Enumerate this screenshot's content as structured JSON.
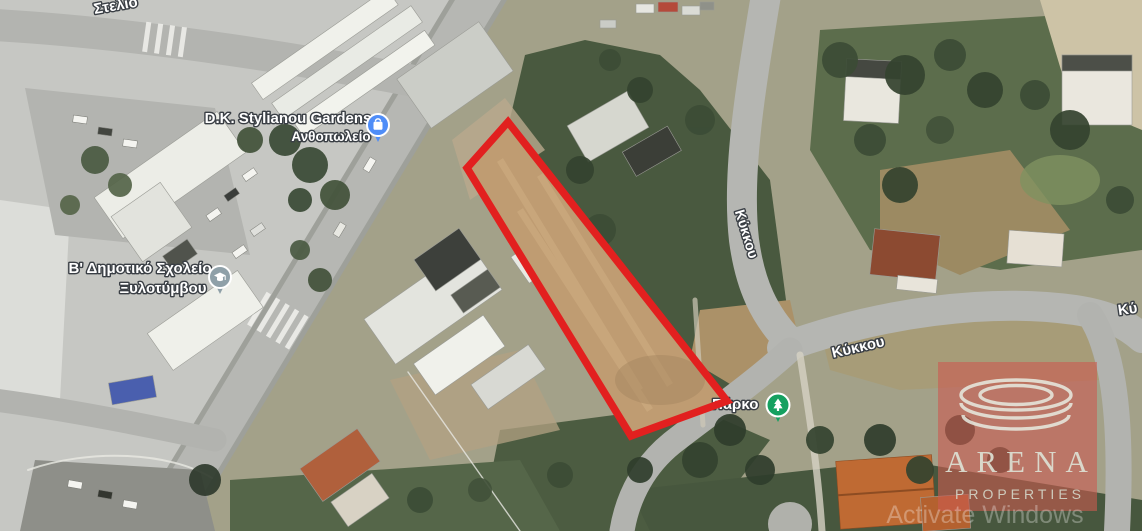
{
  "map": {
    "type": "satellite-view",
    "labels": {
      "street_top": "Στελιο",
      "flower_shop": {
        "name": "D.K. Stylianou Gardens",
        "category": "Ανθοπωλείο",
        "icon": "shopping-bag-pin"
      },
      "school": {
        "line1": "Β' Δημοτικό Σχολείο",
        "line2": "Ξυλοτύμβου",
        "icon": "graduation-cap-pin"
      },
      "kykkou_ns": "Κύκκου",
      "kykkou_ew": "Κύκκου",
      "kykkou_edge": "Κύ",
      "park": {
        "name": "Πάρκο",
        "icon": "park-tree-pin"
      }
    },
    "colors": {
      "plot_outline": "#e2201f",
      "flower_pin": "#4f8df7",
      "school_pin": "#8fa0a8",
      "park_pin": "#15a060",
      "road": "#b6b7b3",
      "dirt_plot": "#bf9c72"
    }
  },
  "watermarks": {
    "arena": {
      "brand": "ARENA",
      "sub": "PROPERTIES",
      "logo": "arena-rings",
      "overlay_color": "#cc5a50"
    },
    "os": "Activate Windows"
  }
}
